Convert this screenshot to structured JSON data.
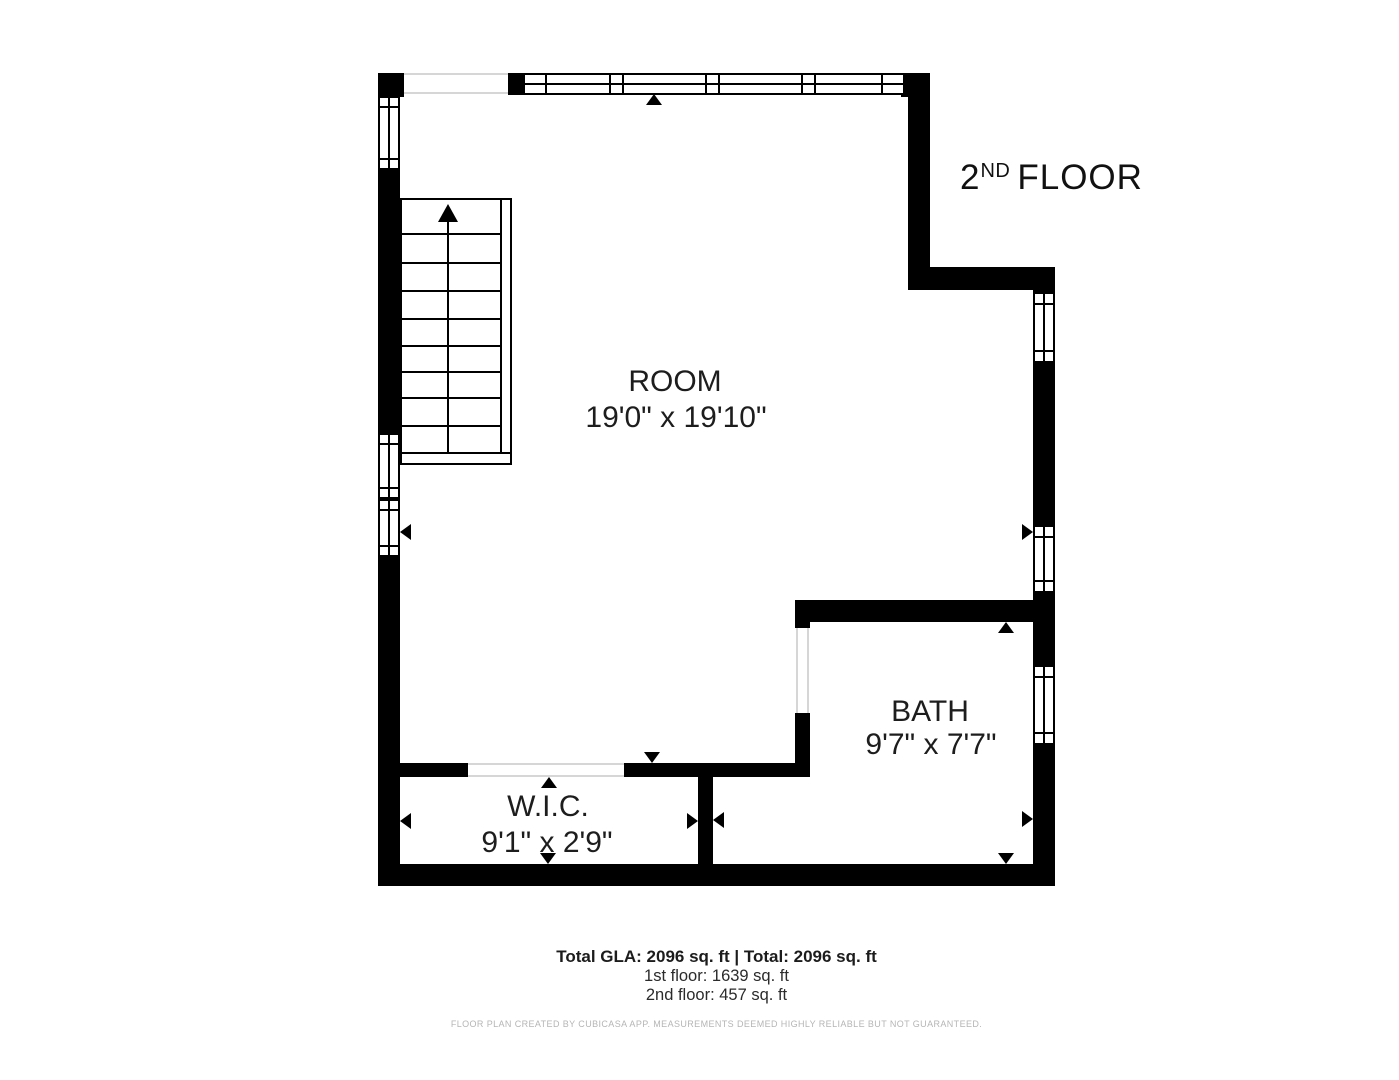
{
  "floor_label": {
    "number": "2",
    "suffix": "ND",
    "word": "FLOOR"
  },
  "rooms": {
    "room": {
      "name": "ROOM",
      "dims": "19'0\" x 19'10\""
    },
    "bath": {
      "name": "BATH",
      "dims": "9'7\" x 7'7\""
    },
    "wic": {
      "name": "W.I.C.",
      "dims": "9'1\" x 2'9\""
    }
  },
  "summary": {
    "total_line": "Total GLA: 2096 sq. ft | Total: 2096 sq. ft",
    "first_floor": "1st floor: 1639 sq. ft",
    "second_floor": "2nd floor: 457 sq. ft"
  },
  "disclaimer": "FLOOR PLAN CREATED BY CUBICASA APP. MEASUREMENTS DEEMED HIGHLY RELIABLE BUT NOT GUARANTEED.",
  "colors": {
    "wall": "#000000",
    "text": "#1d1d1d",
    "muted": "#b5b5b5",
    "opening_line": "#d6d6d6"
  }
}
